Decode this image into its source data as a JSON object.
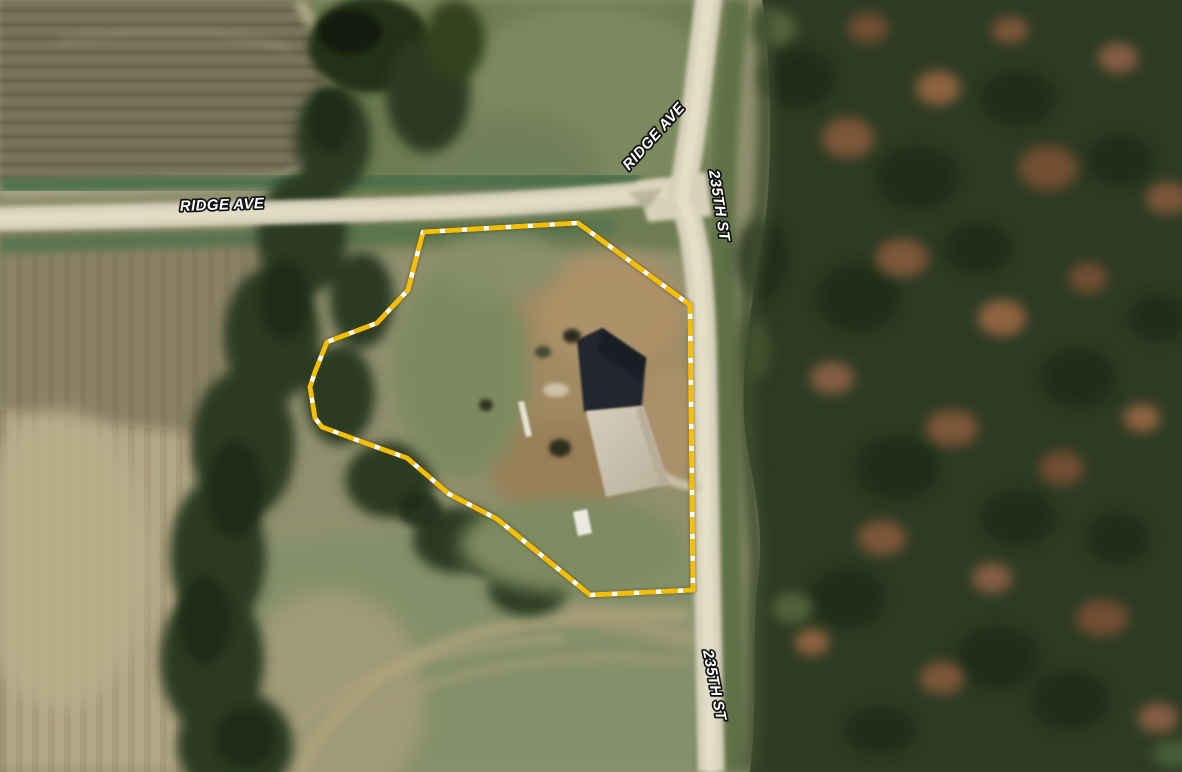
{
  "map": {
    "description": "Aerial satellite view of a rural parcel at the corner of Ridge Ave and 235th St",
    "road_labels": [
      {
        "id": "ridge-ave-west",
        "text": "RIDGE AVE"
      },
      {
        "id": "ridge-ave-north",
        "text": "RIDGE AVE"
      },
      {
        "id": "235th-st-north",
        "text": "235TH ST"
      },
      {
        "id": "235th-st-south",
        "text": "235TH ST"
      }
    ]
  },
  "parcel": {
    "boundary_points": "423,232 578,223 690,305 693,590 590,595 497,519 449,494 407,458 357,440 322,427 315,418 310,387 315,372 327,342 377,323 408,290",
    "boundary_color": "#F5BE00",
    "boundary_gap_color": "#FFFFFF"
  },
  "label_style": {
    "fill": "#FFFFFF",
    "outline": "#121212"
  }
}
